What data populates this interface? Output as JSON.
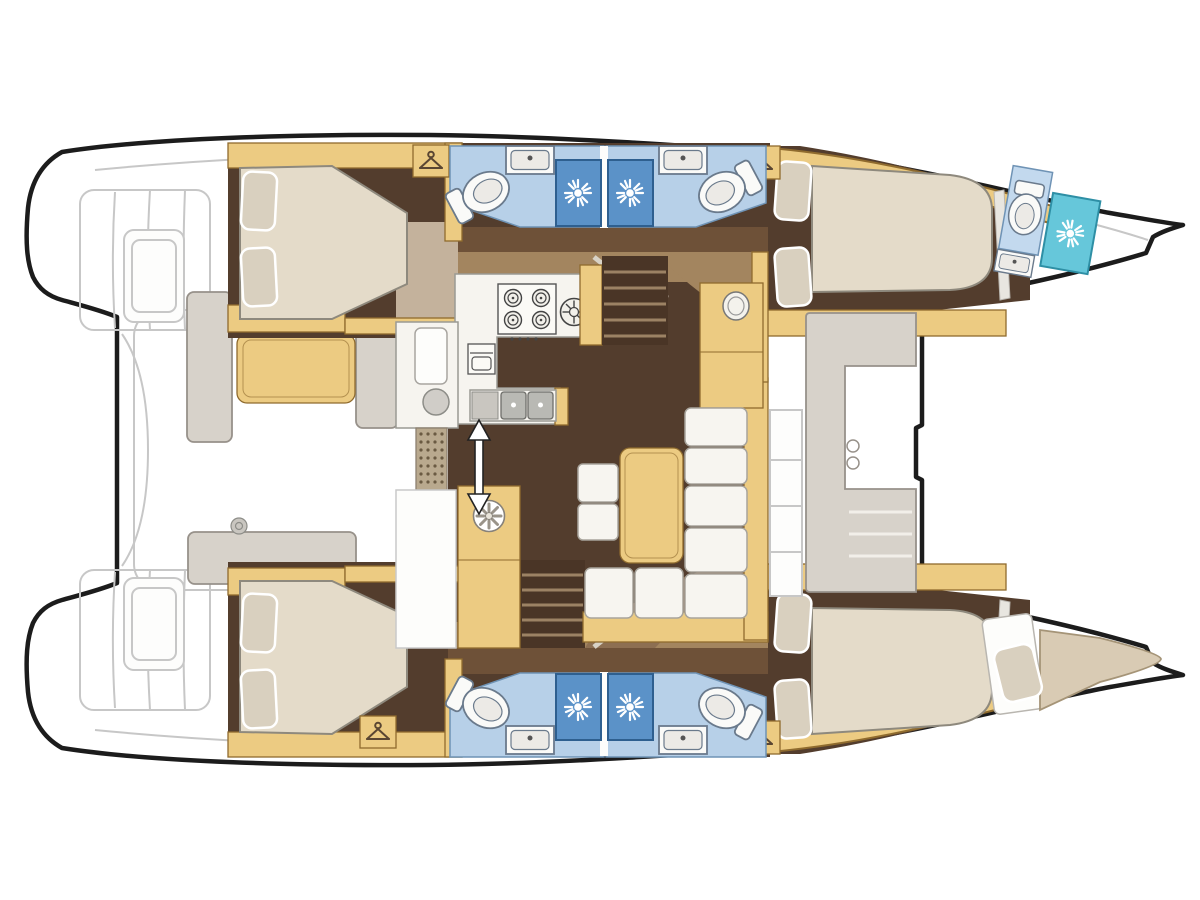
{
  "figure": {
    "kind": "boat-floorplan",
    "subject": "catamaran-interior-top-view",
    "counts": {
      "double_bed_cabins": 4,
      "bow_single_berths": 1,
      "toilets": 5,
      "shower_stalls": 5,
      "washbasins": 5,
      "stove_burners": 4,
      "galley_sinks": 2,
      "companionway_stairs": 2,
      "cockpit_tables": 1,
      "saloon_tables": 1
    }
  },
  "icons": [
    "shower-sunburst-icon",
    "toilet-icon",
    "washbasin-icon",
    "clothes-hanger-wardrobe-icon",
    "stove-burner-icon",
    "oven-icon",
    "double-sink-icon",
    "round-hob-icon",
    "fridge-vent-fan-icon",
    "sliding-door-double-arrow-icon",
    "winch-icon",
    "cupholder-icon"
  ],
  "colors": {
    "outline": "#1c1c1c",
    "deck-line": "#c7c7c7",
    "wood": "#eccb82",
    "wood-border": "#8f6b2e",
    "floor-dark": "#533d2d",
    "floor-mid": "#6e5138",
    "floor-tan": "#a3855f",
    "floor-tan2": "#8d6f52",
    "floor-light-tan": "#c4b29c",
    "mattress": "#e4dbc9",
    "mattress-border": "#8e897d",
    "pillow": "#d9d0bf",
    "bath-floor": "#b7d0e8",
    "bath-floor-light": "#c3d9ee",
    "bath-border": "#6f93b5",
    "shower": "#5b92c8",
    "shower-border": "#2e5f8f",
    "shower-cyan": "#66c7da",
    "shower-cyan-border": "#2e8fa5",
    "fixture": "#fafaf8",
    "fixture-border": "#6a7a8c",
    "bench": "#d7d2ca",
    "bench-border": "#97918a",
    "sofa": "#f7f5f0",
    "sofa-border": "#a8a49c",
    "counter": "#f6f4ef",
    "counter-border": "#9a9a93",
    "steel": "#c9c6c0",
    "mat-tan": "#b9a98e",
    "mat-dot": "#6a5a42",
    "icon-dark": "#5a4632",
    "stairs": "#4a3526",
    "tread": "#9c8264",
    "berth-tan": "#d9cbb4",
    "berth-border": "#a59477"
  }
}
